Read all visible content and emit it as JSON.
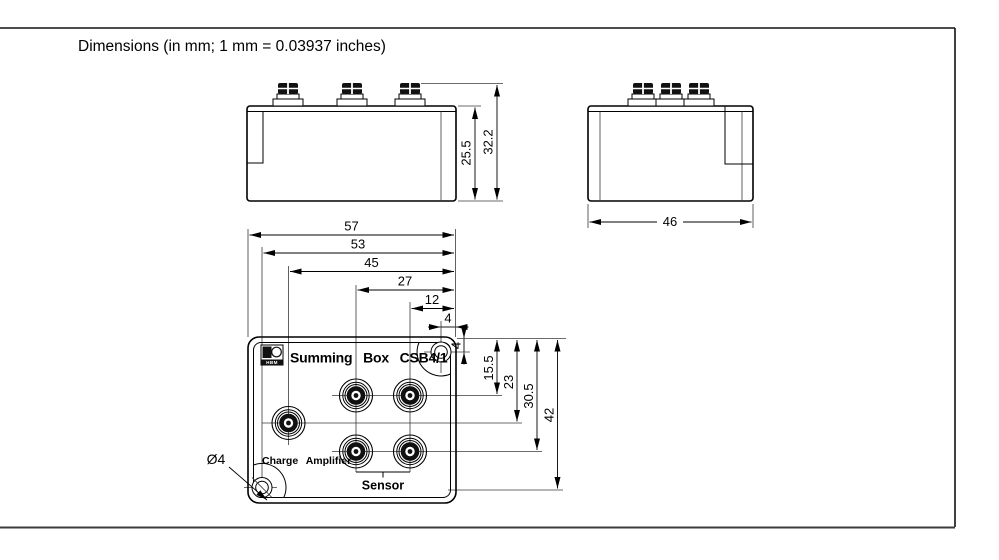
{
  "page": {
    "title": "Dimensions (in mm; 1 mm = 0.03937 inches)"
  },
  "front_view": {
    "dims": {
      "body_height": "25.5",
      "overall_height": "32.2"
    }
  },
  "side_view": {
    "dims": {
      "width": "46"
    }
  },
  "top_view": {
    "product_label": "Summing Box CSB4/1",
    "logo_text": "HBM",
    "charge_amplifier_label": "Charge Amplifier",
    "sensor_label": "Sensor",
    "hole_diameter_label": "Ø4",
    "dims_horizontal": [
      "57",
      "53",
      "45",
      "27",
      "12",
      "4"
    ],
    "dims_vertical": [
      "4",
      "15.5",
      "23",
      "30.5",
      "42"
    ]
  }
}
